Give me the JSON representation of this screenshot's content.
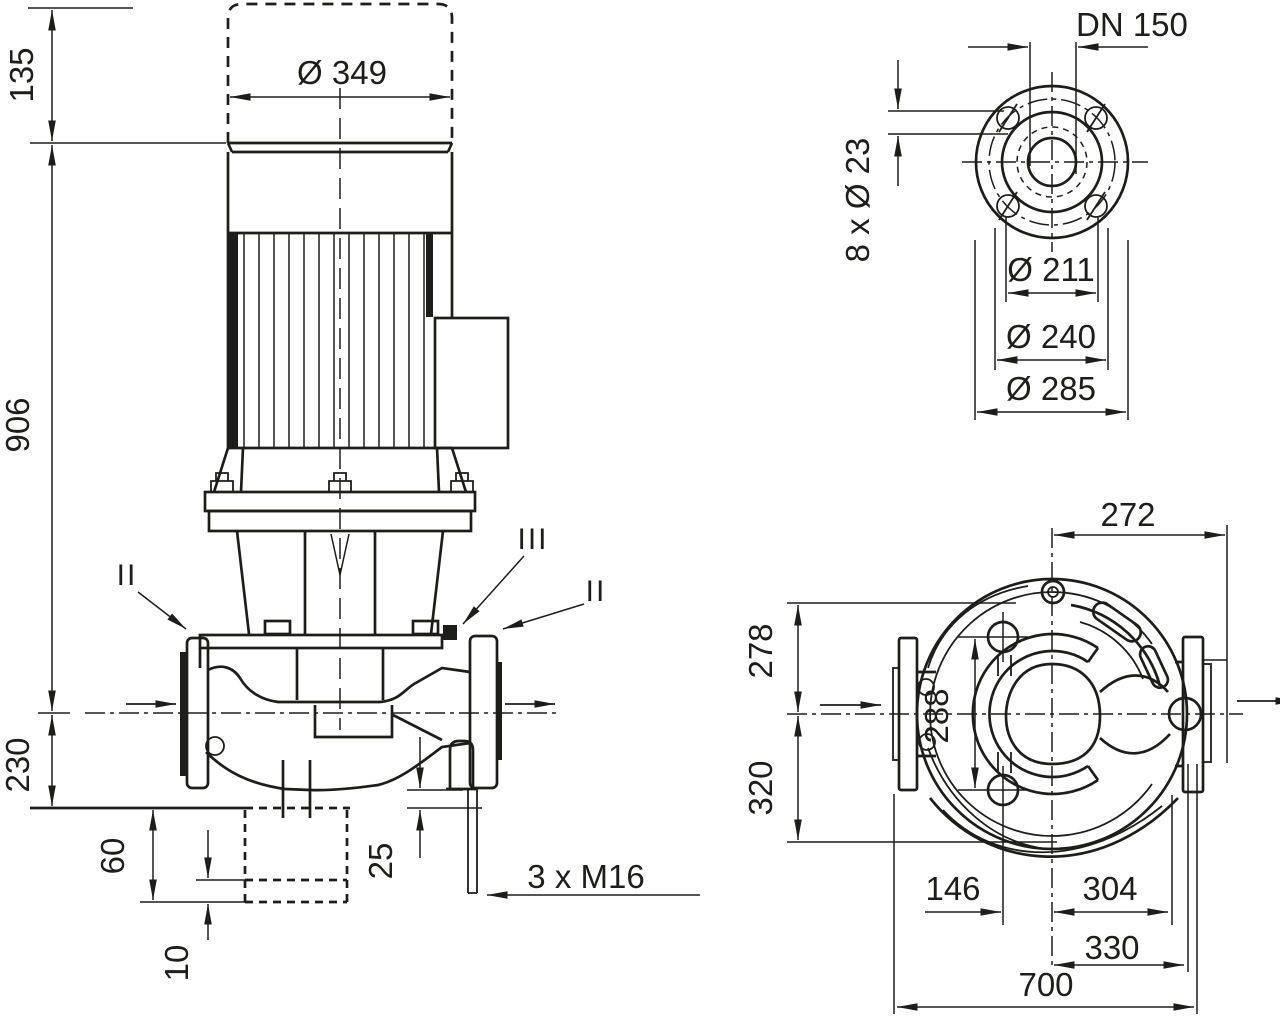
{
  "colors": {
    "line": "#1d1d1b",
    "background": "#ffffff"
  },
  "front_view": {
    "dim_135": "135",
    "dim_349": "Ø 349",
    "dim_906": "906",
    "dim_230": "230",
    "dim_60": "60",
    "dim_10": "10",
    "dim_25": "25",
    "studs_label": "3 x M16",
    "section_left": "II",
    "section_mid": "III",
    "section_right": "II"
  },
  "flange_view": {
    "dn_label": "DN 150",
    "bolt_holes_label": "8 x Ø 23",
    "dim_211": "Ø 211",
    "dim_240": "Ø 240",
    "dim_285": "Ø 285"
  },
  "top_view": {
    "dim_272": "272",
    "dim_278": "278",
    "dim_320": "320",
    "dim_288": "288",
    "dim_146": "146",
    "dim_304": "304",
    "dim_330": "330",
    "dim_700": "700"
  }
}
